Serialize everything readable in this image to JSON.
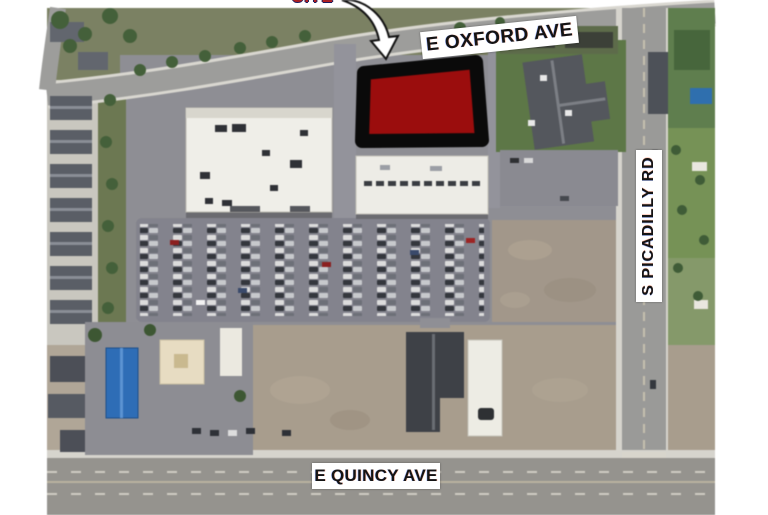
{
  "figure": {
    "callout": {
      "label": "SITE"
    },
    "streets": [
      {
        "name": "E OXFORD AVE"
      },
      {
        "name": "S PICADILLY RD"
      },
      {
        "name": "E QUINCY AVE"
      }
    ],
    "site_parcel": {
      "fill": "#9b0d0d",
      "outline": "#0a0a0a"
    }
  }
}
